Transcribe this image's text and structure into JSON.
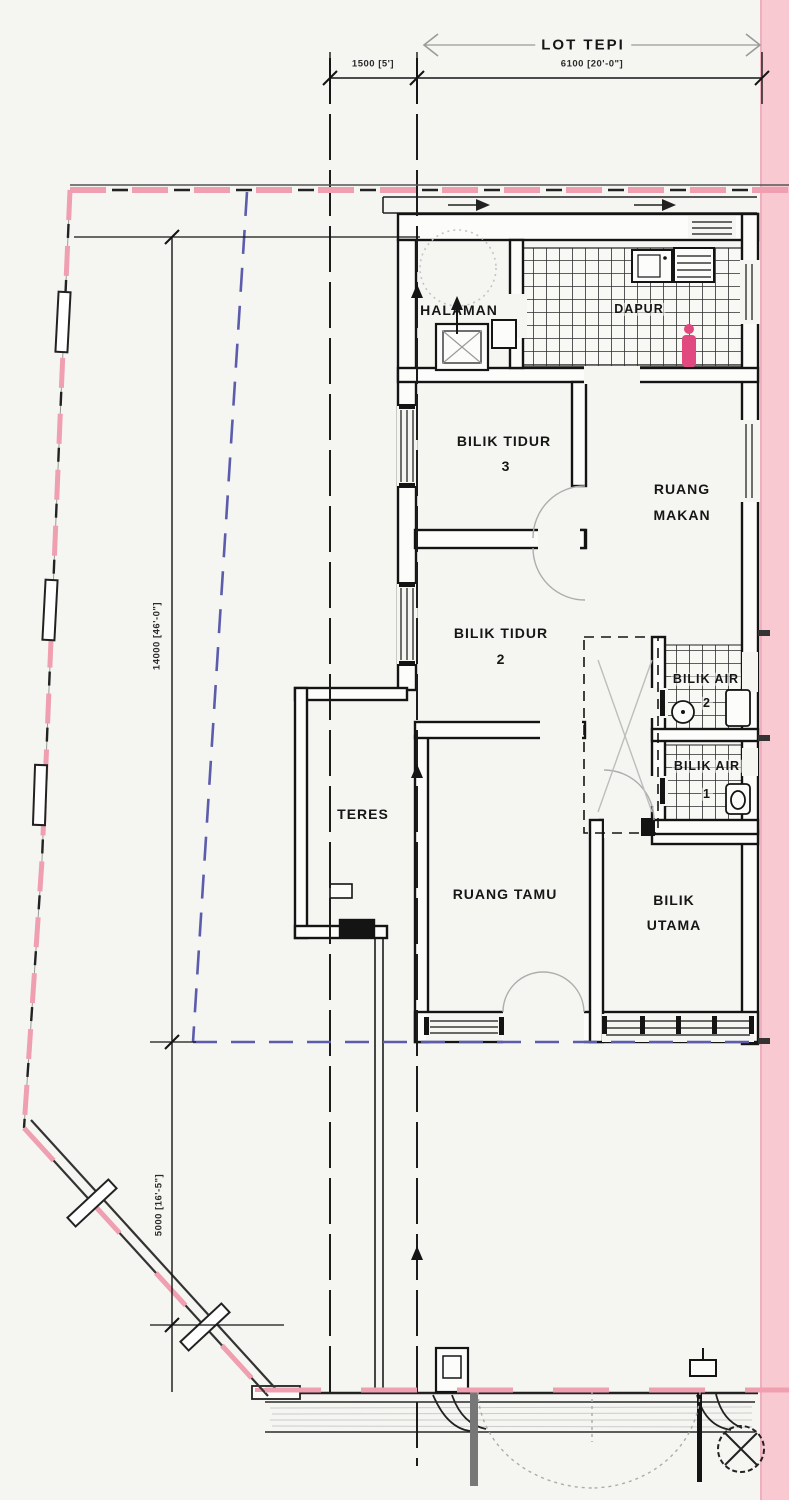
{
  "plan": {
    "lot_label": "LOT TEPI",
    "dimensions": {
      "top_left": "1500 [5']",
      "top_span": "6100 [20'-0\"]",
      "side_upper": "14000 [46'-0\"]",
      "side_lower": "5000 [16'-5\"]"
    },
    "rooms": {
      "halaman": "HALAMAN",
      "dapur": "DAPUR",
      "bilik_tidur_3": [
        "BILIK TIDUR",
        "3"
      ],
      "ruang_makan": [
        "RUANG",
        "MAKAN"
      ],
      "bilik_tidur_2": [
        "BILIK TIDUR",
        "2"
      ],
      "bilik_air_2": [
        "BILIK AIR",
        "2"
      ],
      "bilik_air_1": [
        "BILIK AIR",
        "1"
      ],
      "teres": "TERES",
      "ruang_tamu": "RUANG TAMU",
      "bilik_utama": [
        "BILIK",
        "UTAMA"
      ]
    },
    "colors": {
      "boundary_pink": "#ef9fb0",
      "side_lot_band_pink": "#f8c9d1",
      "setback_blue": "#5c5cac",
      "wall_black": "#141414",
      "figure_pink": "#e0487e"
    }
  }
}
